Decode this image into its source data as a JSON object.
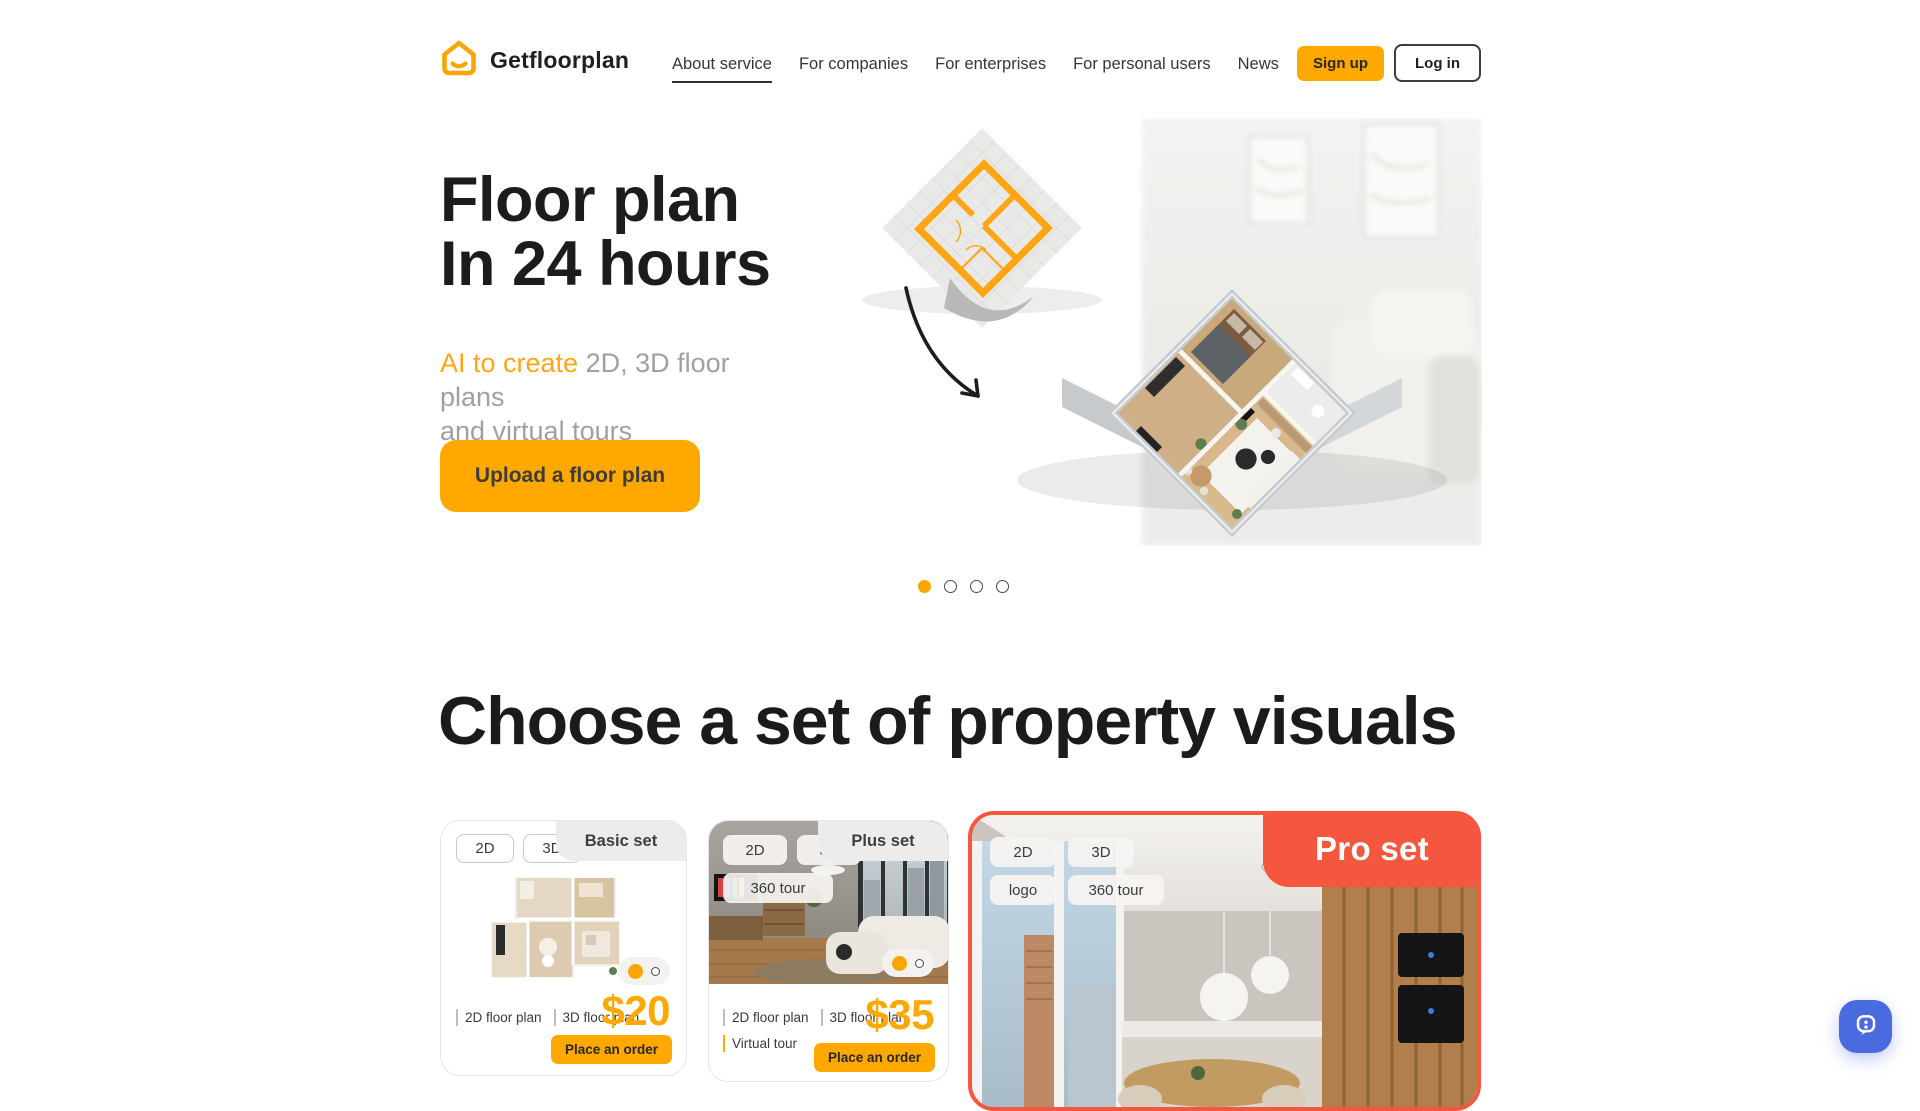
{
  "brand": {
    "name": "Getfloorplan"
  },
  "nav": {
    "items": [
      {
        "label": "About service",
        "active": true
      },
      {
        "label": "For companies",
        "active": false
      },
      {
        "label": "For enterprises",
        "active": false
      },
      {
        "label": "For personal users",
        "active": false
      },
      {
        "label": "News",
        "active": false
      }
    ]
  },
  "auth": {
    "signup": "Sign up",
    "login": "Log in"
  },
  "hero": {
    "title_line1": "Floor plan",
    "title_line2": "In 24 hours",
    "subtitle_highlight": "AI to create",
    "subtitle_line1_rest": " 2D, 3D floor plans",
    "subtitle_line2": "and virtual tours",
    "cta": "Upload a floor plan",
    "carousel": {
      "dot_count": 4,
      "active_index": 0
    }
  },
  "section": {
    "title": "Choose a set of property visuals"
  },
  "cards": [
    {
      "name": "Basic set",
      "badges": [
        "2D",
        "3D"
      ],
      "features": [
        "2D floor plan",
        "3D floor plan"
      ],
      "price": "$20",
      "cta": "Place an order"
    },
    {
      "name": "Plus set",
      "badges": [
        "2D",
        "3D",
        "360 tour"
      ],
      "features": [
        "2D floor plan",
        "3D floor plan",
        "Virtual tour"
      ],
      "price": "$35",
      "cta": "Place an order"
    },
    {
      "name": "Pro set",
      "badges": [
        "2D",
        "3D",
        "logo",
        "360 tour"
      ]
    }
  ],
  "colors": {
    "accent_orange": "#FFA800",
    "accent_orange_text": "#F9A602",
    "pro_red": "#F4573D",
    "chat_blue": "#4A6BE0",
    "text_dark": "#1c1c1c",
    "text_gray": "#9fa0a2"
  }
}
